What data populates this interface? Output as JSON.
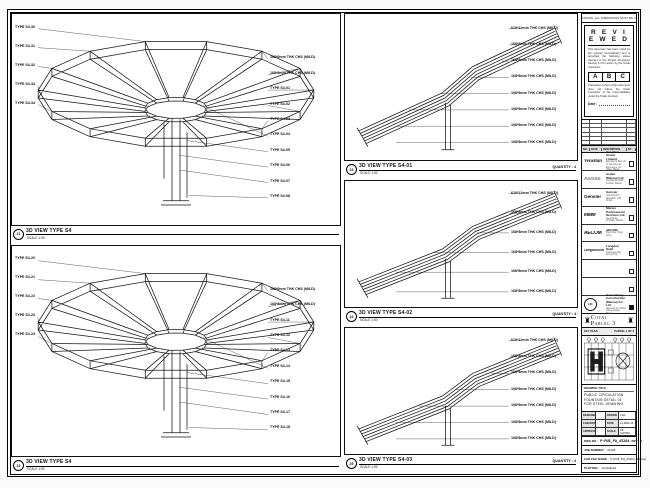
{
  "notes": {
    "top_strip": "DO NOT SCALE DRAWING. ALL DIMENSIONS MUST BE VERIFIED ON SITE."
  },
  "views": [
    {
      "bubble": "21",
      "title": "3D VIEW TYPE S4",
      "scale": "SCALE 1:50",
      "quantity": "",
      "left_labels": [
        "TYPE S4-30",
        "TYPE S4-31",
        "TYPE S4-32",
        "TYPE S4-33",
        "TYPE S4-34"
      ],
      "right_labels": [
        "168*8mm THK CHS (MILD)",
        "168*8mm THK CHS (MILD)",
        "TYPE S4-01",
        "TYPE S4-02",
        "TYPE S4-03",
        "TYPE S4-04",
        "TYPE S4-05",
        "TYPE S4-06",
        "TYPE S4-07",
        "TYPE S4-08"
      ]
    },
    {
      "bubble": "22",
      "title": "3D VIEW TYPE S4",
      "scale": "SCALE 1:50",
      "quantity": "",
      "left_labels": [
        "TYPE S4-20",
        "TYPE S4-21",
        "TYPE S4-22",
        "TYPE S4-23",
        "TYPE S4-24"
      ],
      "right_labels": [
        "168*8mm THK CHS (MILD)",
        "168*8mm THK CHS (MILD)",
        "TYPE S4-11",
        "TYPE S4-12",
        "TYPE S4-13",
        "TYPE S4-14",
        "TYPE S4-15",
        "TYPE S4-16",
        "TYPE S4-17",
        "TYPE S4-18"
      ]
    },
    {
      "bubble": "23",
      "title": "3D VIEW TYPE S4-01",
      "scale": "SCALE 1:50",
      "quantity": "QUANTITY : 4",
      "labels": [
        "610*12mm THK CHS (MILD)",
        "168*8mm THK CHS (MILD)",
        "168*8mm THK CHS (MILD)",
        "168*8mm THK CHS (MILD)",
        "168*8mm THK CHS (MILD)",
        "168*8mm THK CHS (MILD)",
        "168*8mm THK CHS (MILD)",
        "168*8mm THK CHS (MILD)"
      ]
    },
    {
      "bubble": "24",
      "title": "3D VIEW TYPE S4-02",
      "scale": "SCALE 1:50",
      "quantity": "QUANTITY : 4",
      "labels": [
        "610*12mm THK CHS (MILD)",
        "168*8mm THK CHS (MILD)",
        "168*8mm THK CHS (MILD)",
        "168*8mm THK CHS (MILD)",
        "168*8mm THK CHS (MILD)",
        "168*8mm THK CHS (MILD)"
      ]
    },
    {
      "bubble": "25",
      "title": "3D VIEW TYPE S4-03",
      "scale": "SCALE 1:50",
      "quantity": "QUANTITY : 4",
      "labels": [
        "610*12mm THK CHS (MILD)",
        "168*8mm THK CHS (MILD)",
        "168*8mm THK CHS (MILD)",
        "168*8mm THK CHS (MILD)",
        "168*8mm THK CHS (MILD)",
        "168*8mm THK CHS (MILD)",
        "168*8mm THK CHS (MILD)"
      ]
    }
  ],
  "stamp": {
    "title": "R E V I E W E D",
    "body1": "This document has been noted by the relevant Consultant(s) and is accorded the following status relevant to the Project Procedure Section 5.4 for action by the Trade Contractor.",
    "grades": [
      "A",
      "B",
      "C"
    ],
    "body2": "Consultant review of this document does not relieve the Trade Contractor of his responsibilities under the Trade Contract.",
    "date_label": "Date :"
  },
  "revision": {
    "headers": [
      "NO.",
      "DATE",
      "DESCRIPTION",
      "BY"
    ],
    "rows": 6
  },
  "consultants": [
    {
      "logo": "Venetian",
      "name": "Venetian Orient Limited",
      "sub": "Estrada da Baía de N. Senhora da Esperança, s/n, Taipa, Macau"
    },
    {
      "logo": "Aedas",
      "name": "Aedas (Macau) Ltd.",
      "sub": "Avenida da Praia Grande, Macau"
    },
    {
      "logo": "Gensler",
      "name": "Gensler",
      "sub": "Xuhui District, Shanghai, P.R. China"
    },
    {
      "logo": "MMM",
      "name": "Macau Professional Services Ltd.",
      "sub": "Avenida da Amizade, Macau"
    },
    {
      "logo": "AECOM",
      "name": "AECOM",
      "sub": "Wan Chai, Hong Kong"
    },
    {
      "logo": "LangdonSeah",
      "name": "Langdon Seah",
      "sub": "Causeway Bay, Hong Kong"
    },
    {
      "logo": "",
      "name": "",
      "sub": ""
    },
    {
      "logo": "",
      "name": "",
      "sub": ""
    },
    {
      "logo": "HC",
      "name": "Hsin Chong Construction (Macau) Co. Ltd.",
      "sub": "Alameda Dr. Carlos d'Assumpção, Macau",
      "contractor": true
    }
  ],
  "project": {
    "name": "Cotai Parcel 3",
    "icon": "♜"
  },
  "key_plan": {
    "label": "KEY PLAN",
    "right": "PARCEL 1 OF 3"
  },
  "title_block": {
    "drawing_title_label": "DRAWING TITLE :",
    "drawing_title_lines": [
      "PUBLIC CIRCULATION",
      "FOUNTAIN DETAIL 01",
      "FOR STEEL DRAWING"
    ],
    "fields": [
      [
        "DESIGNED",
        "-",
        "DRAWN",
        "CAD"
      ],
      [
        "CHECKED",
        "-",
        "DATE",
        "14-MAR-16"
      ],
      [
        "APPROVED",
        "-",
        "SCALE",
        "AS SHOWN"
      ]
    ],
    "dwg_no_label": "DWG NO :",
    "dwg_no": "P-PUB_PQ_45204",
    "rev_label": "REV :",
    "rev": "A",
    "job_label": "JOB NUMBER :",
    "job": "21328",
    "cad_label": "CAD FILE NAME :",
    "cad": "P-PUB_PQ_45204_S4.dwg",
    "plot_label": "PLOTTED :",
    "plot": "14-MAR-16"
  }
}
